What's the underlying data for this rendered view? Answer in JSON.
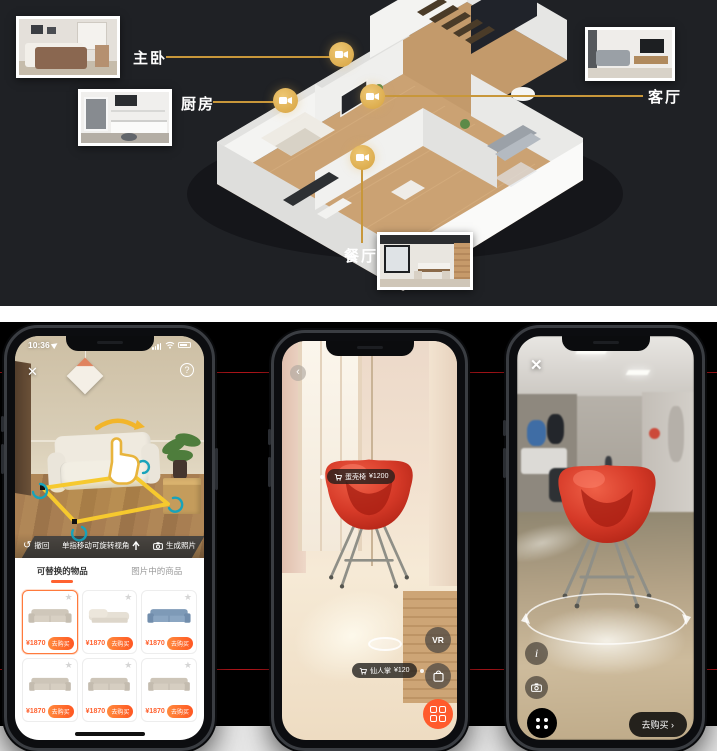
{
  "top_section": {
    "rooms": [
      {
        "label": "主卧"
      },
      {
        "label": "厨房"
      },
      {
        "label": "客厅"
      },
      {
        "label": "餐厅"
      }
    ]
  },
  "left_phone": {
    "status_time": "10:36",
    "close_glyph": "✕",
    "help_glyph": "?",
    "toolbar": {
      "undo_glyph": "↺",
      "undo_label": "撤回",
      "rotate_hint": "单指移动可旋转视角",
      "generate_label": "生成照片"
    },
    "tabs": [
      {
        "label": "可替换的物品"
      },
      {
        "label": "图片中的商品"
      }
    ],
    "star_glyph": "★",
    "buy_label": "去购买",
    "products": [
      {
        "price": "¥1870"
      },
      {
        "price": "¥1870"
      },
      {
        "price": "¥1870"
      },
      {
        "price": "¥1870"
      },
      {
        "price": "¥1870"
      },
      {
        "price": "¥1870"
      }
    ]
  },
  "middle_phone": {
    "back_glyph": "‹",
    "product_tag": {
      "name": "蛋壳椅",
      "price": "¥1200"
    },
    "secondary_tag": {
      "name": "仙人掌",
      "price": "¥120"
    },
    "vr_label": "VR"
  },
  "right_phone": {
    "close_glyph": "✕",
    "info_label": "i",
    "buy_label": "去购买 ›"
  },
  "colors": {
    "accent_orange": "#ff6230",
    "gold": "#d6a23f",
    "red_line": "#b3151a",
    "chair_red": "#d63a28"
  }
}
